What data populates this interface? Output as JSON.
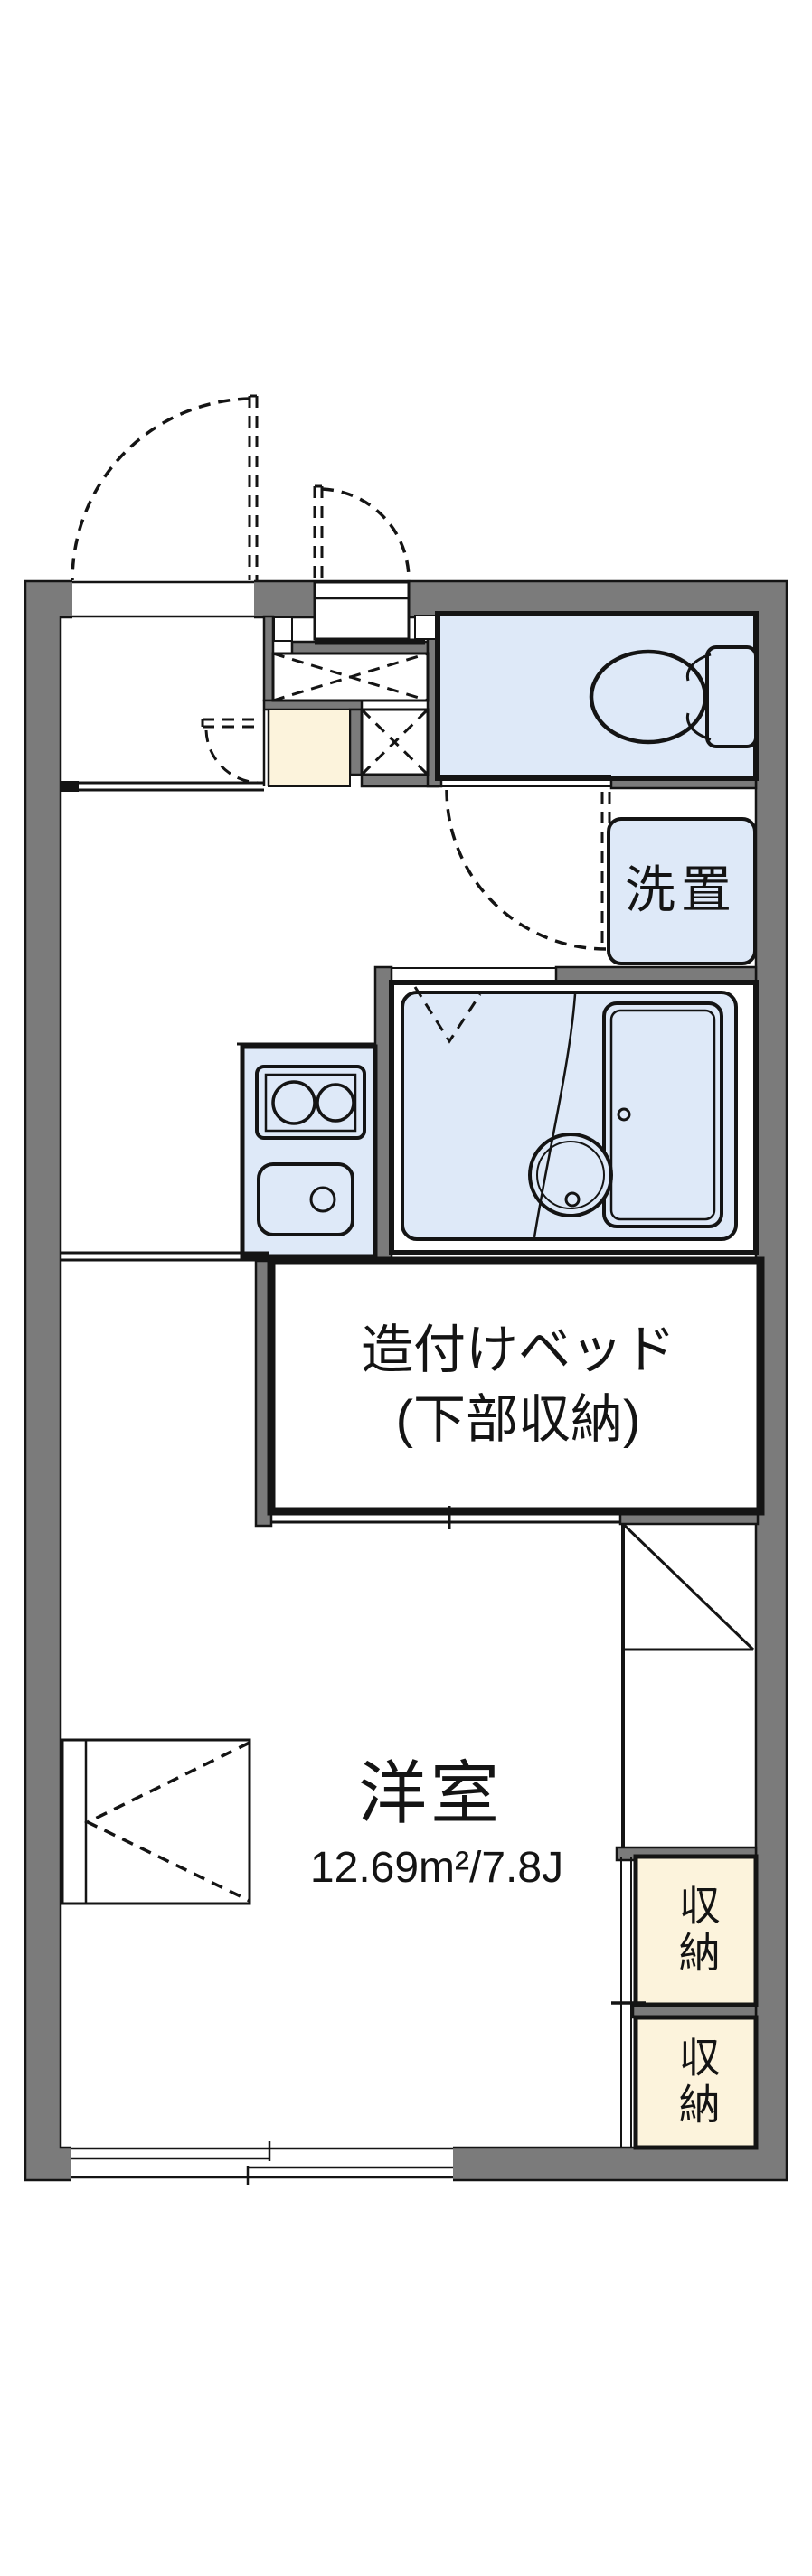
{
  "colors": {
    "wall": "#7b7b7b",
    "water": "#dee9f8",
    "storage": "#fcf3dc",
    "line": "#141414"
  },
  "rooms": {
    "laundry": {
      "label": "洗置"
    },
    "built_in_bed": {
      "label_line1": "造付けベッド",
      "label_line2": "(下部収納)"
    },
    "western_room": {
      "name": "洋室",
      "area": "12.69m²/7.8J"
    },
    "closet_upper": {
      "label": "収納"
    },
    "closet_lower": {
      "label": "収納"
    }
  }
}
